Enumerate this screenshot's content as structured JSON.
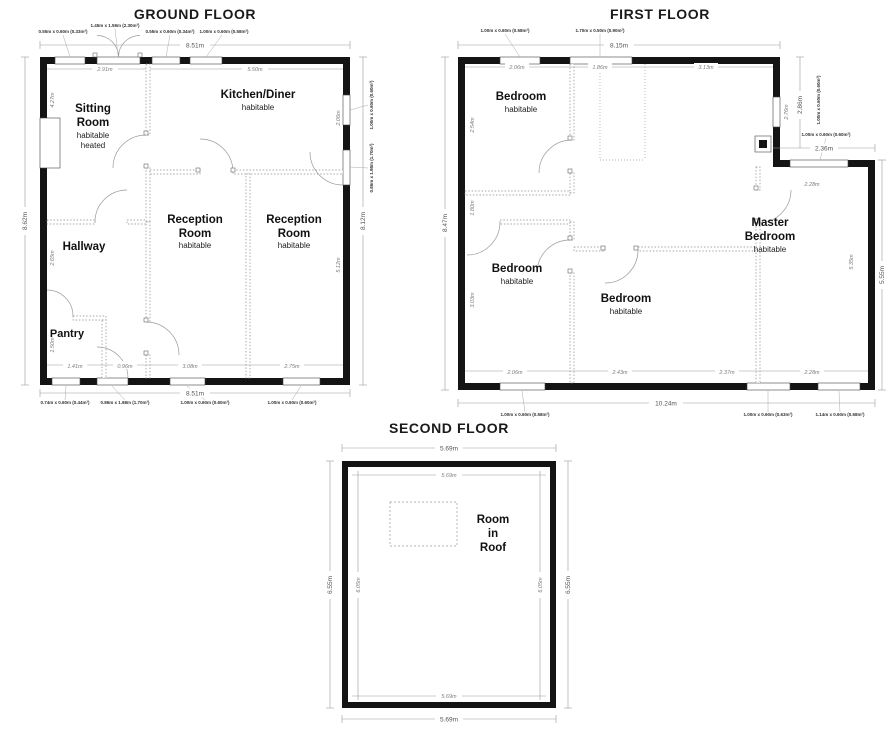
{
  "colors": {
    "wall": "#141414",
    "dimension_lines": "#9a9a9a",
    "text": "#1a1a1a",
    "background": "#ffffff"
  },
  "ground": {
    "title": "GROUND FLOOR",
    "dim_top": "8.51m",
    "dim_bottom": "8.51m",
    "dim_left": "8.62m",
    "dim_right": "8.12m",
    "top_labels": [
      "0.55m x 0.60m (0.33m²)",
      "1.45m x 1.59m (2.30m²)",
      "0.55m x 0.60m (0.34m²)",
      "1.00m x 0.60m (0.58m²)"
    ],
    "right_labels": [
      "1.00m x 0.60m (0.60m²)",
      "0.86m x 1.98m (1.70m²)"
    ],
    "bottom_labels": [
      "0.74m x 0.60m (0.44m²)",
      "0.86m x 1.98m (1.70m²)",
      "1.00m x 0.60m (0.60m²)",
      "1.00m x 0.60m (0.60m²)"
    ],
    "inner": {
      "sitting_w": "2.91m",
      "kitchen_w": "5.50m",
      "sitting_h": "4.27m",
      "hall_h": "2.65m",
      "pantry_h": "1.50m",
      "pantry_w": "1.41m",
      "hall_w": "0.96m",
      "rec1_w": "3.08m",
      "rec2_w": "2.75m",
      "rec_h": "5.12m",
      "kitchen_r": "2.06m"
    },
    "rooms": {
      "sitting": {
        "line1": "Sitting",
        "line2": "Room",
        "sub1": "habitable",
        "sub2": "heated"
      },
      "kitchen": {
        "name": "Kitchen/Diner",
        "sub": "habitable"
      },
      "reception1": {
        "line1": "Reception",
        "line2": "Room",
        "sub": "habitable"
      },
      "reception2": {
        "line1": "Reception",
        "line2": "Room",
        "sub": "habitable"
      },
      "hallway": {
        "name": "Hallway"
      },
      "pantry": {
        "name": "Pantry"
      }
    }
  },
  "first": {
    "title": "FIRST FLOOR",
    "dim_top": "8.15m",
    "dim_bottom": "10.24m",
    "dim_left": "8.47m",
    "dim_right": "5.55m",
    "dim_notch_v": "2.86m",
    "dim_notch_h": "2.36m",
    "dim_notch_inner": "2.76m",
    "dim_ext_top": "2.28m",
    "top_labels": [
      "1.00m x 0.60m (0.58m²)",
      "1.70m x 0.50m (0.90m²)"
    ],
    "bottom_labels": [
      "1.00m x 0.60m (0.58m²)",
      "1.00m x 0.60m (0.63m²)",
      "1.14m x 0.60m (0.68m²)"
    ],
    "notch_label_v": "1.00m x 0.60m (0.60m²)",
    "notch_label_h": "1.00m x 0.60m (0.60m²)",
    "inner": {
      "top1": "2.06m",
      "top2": "1.86m",
      "top3": "3.13m",
      "left1": "2.54m",
      "left2": "1.80m",
      "left3": "3.03m",
      "bot1": "2.06m",
      "bot2": "2.43m",
      "bot3": "2.37m",
      "bot4": "2.28m",
      "master_h": "5.35m"
    },
    "rooms": {
      "bedroom1": {
        "name": "Bedroom",
        "sub": "habitable"
      },
      "bedroom2": {
        "name": "Bedroom",
        "sub": "habitable"
      },
      "bedroom3": {
        "name": "Bedroom",
        "sub": "habitable"
      },
      "master": {
        "line1": "Master",
        "line2": "Bedroom",
        "sub": "habitable"
      }
    }
  },
  "second": {
    "title": "SECOND FLOOR",
    "dim_top": "5.69m",
    "dim_bottom": "5.69m",
    "dim_left": "6.55m",
    "dim_right": "6.55m",
    "inner": {
      "top": "5.69m",
      "bottom": "5.69m",
      "left": "6.05m",
      "right": "6.05m"
    },
    "rooms": {
      "roof": {
        "line1": "Room",
        "line2": "in",
        "line3": "Roof"
      }
    }
  }
}
